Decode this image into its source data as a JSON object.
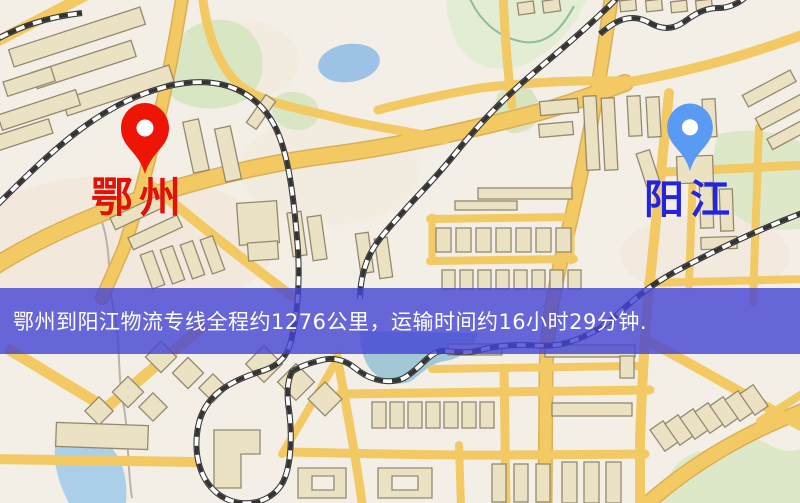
{
  "banner": {
    "text": "鄂州到阳江物流专线全程约1276公里，运输时间约16小时29分钟.",
    "background_color": "#4444d6",
    "text_color": "#ffffff"
  },
  "markers": {
    "origin": {
      "name": "鄂州",
      "pin_color": "#ee1506",
      "label_color": "#e11205"
    },
    "destination": {
      "name": "阳江",
      "pin_color": "#5b9af2",
      "label_color": "#2424e0"
    }
  },
  "route_info": {
    "distance": "约1276公里",
    "duration": "约16小时29分钟"
  },
  "map_colors": {
    "background": "#f3efe6",
    "road": "#f2c963",
    "road_casing": "#dcaf55",
    "park": "#d9e6c4",
    "water": "#9fc6e8",
    "building": "#ebe1c3",
    "railway": "#3a3a3a"
  }
}
